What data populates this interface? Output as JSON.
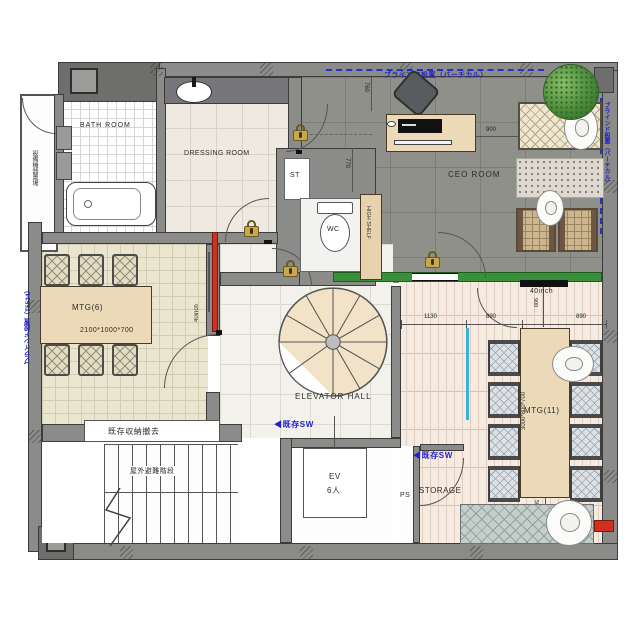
{
  "labels": {
    "bath_room": "BATH ROOM",
    "dressing_room": "DRESSING ROOM",
    "ceo_room": "CEO ROOM",
    "mtg6": "MTG(6)",
    "mtg6_size": "2100*1000*700",
    "mtg11": "MTG(11)",
    "mtg11_size": "3000*800*700",
    "elevator_hall": "ELEVATOR HALL",
    "storage": "STORAGE",
    "ev": "EV",
    "ev_capacity": "6人",
    "ps": "PS",
    "st": "ST",
    "wc": "WC",
    "high_shelf": "HIGH SHELF",
    "outdoor_stairs": "屋外避難階段",
    "equipment_space": "設備機器置場",
    "remove_existing_storage": "既存収納撤去"
  },
  "annotations": {
    "blind_top": "ブラインド設置（バーチカル）",
    "blind_left": "ブラインド設置（T5524）",
    "blind_right": "ブラインド設置（バーチカル）",
    "existing_switch": "◀既存SW",
    "display_40inch": "40inch"
  },
  "dimensions": {
    "desk_to_sofa": "900",
    "wall_top": "760",
    "wall_mid": "770",
    "mtg11_a": "1130",
    "mtg11_b": "890",
    "mtg11_c": "890",
    "table_to_rug": "500",
    "display_offset": "900"
  },
  "colors": {
    "annotation_blue": "#2222cc",
    "whiteboard_green": "#3a8f3a",
    "display_red": "#d03020",
    "lock_gold": "#c9a84c",
    "wall_gray": "#8b8b89"
  }
}
